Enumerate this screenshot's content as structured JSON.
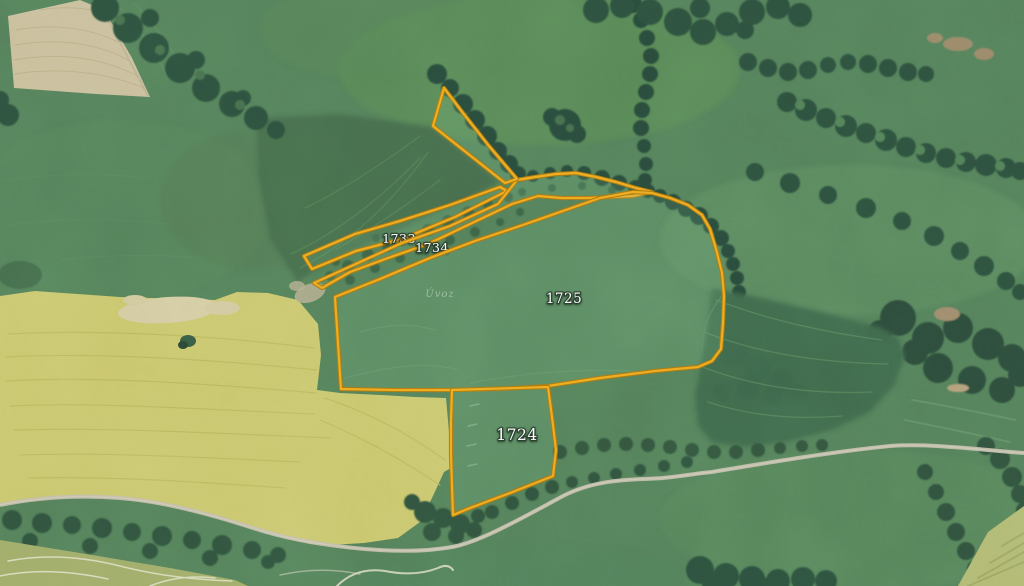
{
  "map": {
    "description": "Aerial imagery with highlighted cadastral land parcels",
    "colors": {
      "parcel_border": "#f0ae22",
      "parcel_border_casing": "#b07a10",
      "parcel_fill": "rgba(150,215,160,0.14)",
      "label_fill": "#ffffff",
      "label_halo": "rgba(40,60,45,0.8)"
    },
    "place_label": {
      "text": "Úvoz",
      "x": 440,
      "y": 297
    },
    "parcels": [
      {
        "id": "1733",
        "label": "1733",
        "label_x": 399,
        "label_y": 243,
        "font_size": 12.5,
        "points": "304,256 355,234 400,221 450,205 500,187 507,191 455,217 402,239 356,251 312,269"
      },
      {
        "id": "1734",
        "label": "1734",
        "label_x": 432,
        "label_y": 252,
        "font_size": 12.5,
        "points": "314,283 358,263 402,243 450,226 498,204 517,180 535,177 556,174 576,173 596,177 616,182 636,188 652,192 633,196 612,197 588,198 562,198 538,196 512,204 470,224 428,244 388,258 350,272 322,288"
      },
      {
        "id": "1734-north-wedge",
        "label": null,
        "label_x": 0,
        "label_y": 0,
        "font_size": 0,
        "points": "444,88 433,126 505,183 517,179 489,146 463,113"
      },
      {
        "id": "1725",
        "label": "1725",
        "label_x": 564,
        "label_y": 303,
        "font_size": 13.5,
        "points": "335,297 380,279 430,258 475,241 520,226 560,212 600,198 633,192 652,193 670,198 688,205 702,215 710,229 716,249 722,273 724,296 723,323 721,349 712,361 698,367 655,371 600,378 548,386 500,389 452,390 395,390 341,389"
      },
      {
        "id": "1724",
        "label": "1724",
        "label_x": 517,
        "label_y": 440,
        "font_size": 15.5,
        "points": "452,390 548,387 552,417 556,450 553,476 510,493 470,508 453,515 451,455 451,420"
      }
    ]
  }
}
